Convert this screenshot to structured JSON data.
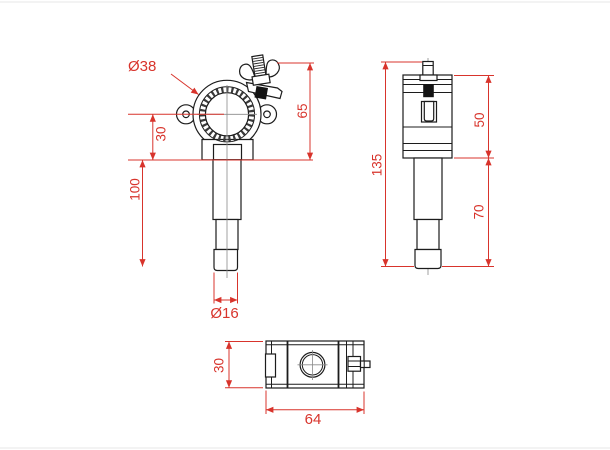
{
  "drawing": {
    "type": "technical-dimension-drawing",
    "subject": "half-coupler clamp with spigot",
    "colors": {
      "dimension": "#d8342c",
      "outline": "#1c1c1c",
      "background": "#ffffff"
    },
    "views": {
      "front": {
        "label": "front view",
        "dims": {
          "tube_diameter": "Ø38",
          "overall_height": "65",
          "center_to_base": "30",
          "spigot_length": "100",
          "tip_diameter": "Ø16"
        }
      },
      "side": {
        "label": "side view",
        "dims": {
          "total_height": "135",
          "body_height": "50",
          "spigot_length": "70"
        }
      },
      "bottom": {
        "label": "bottom view",
        "dims": {
          "depth": "30",
          "width": "64"
        }
      }
    }
  }
}
